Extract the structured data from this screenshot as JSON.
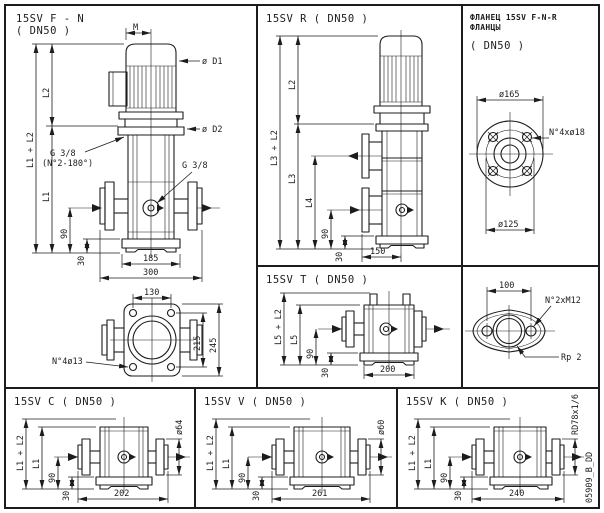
{
  "page": {
    "bg": "#ffffff",
    "ink": "#1c1c1c",
    "doc_code": "05909_B_DD"
  },
  "panel_fn": {
    "title": "15SV F - N",
    "subtitle": "( DN50 )",
    "dim_m": "M",
    "dim_d1": "ø D1",
    "dim_d2": "ø D2",
    "dim_l2": "L2",
    "dim_l1l2": "L1 + L2",
    "dim_l1": "L1",
    "plug1": "G 3/8",
    "plug1_note": "(N°2-180°)",
    "plug2": "G 3/8",
    "dim_90": "90",
    "dim_30": "30",
    "dim_185": "185",
    "dim_300": "300"
  },
  "panel_plan": {
    "dim_130": "130",
    "dim_215": "215",
    "dim_245": "245",
    "holes": "N°4ø13"
  },
  "panel_r": {
    "title": "15SV R ( DN50 )",
    "dim_l2": "L2",
    "dim_l3l2": "L3 + L2",
    "dim_l3": "L3",
    "dim_l4": "L4",
    "dim_90": "90",
    "dim_30": "30",
    "dim_150": "150"
  },
  "panel_flange": {
    "title_line1": "ФЛАНЕЦ 15SV F-N-R",
    "title_line2": "ФЛАНЦЫ",
    "subtitle": "( DN50 )",
    "dim_d165": "ø165",
    "dim_d125": "ø125",
    "holes": "N°4xø18"
  },
  "panel_t": {
    "title": "15SV T ( DN50 )",
    "dim_l5l2": "L5 + L2",
    "dim_l5": "L5",
    "dim_90": "90",
    "dim_30": "30",
    "dim_200": "200"
  },
  "panel_oval": {
    "dim_100": "100",
    "holes": "N°2xM12",
    "thread": "Rp 2"
  },
  "panel_c": {
    "title": "15SV C ( DN50 )",
    "dim_l1l2": "L1 + L2",
    "dim_l1": "L1",
    "dim_90": "90",
    "dim_30": "30",
    "dim_w": "202",
    "dim_port": "ø64"
  },
  "panel_v": {
    "title": "15SV V ( DN50 )",
    "dim_l1l2": "L1 + L2",
    "dim_l1": "L1",
    "dim_90": "90",
    "dim_30": "30",
    "dim_w": "261",
    "dim_port": "ø60"
  },
  "panel_k": {
    "title": "15SV K ( DN50 )",
    "dim_l1l2": "L1 + L2",
    "dim_l1": "L1",
    "dim_90": "90",
    "dim_30": "30",
    "dim_w": "240",
    "dim_port": "RD78x1/6"
  }
}
